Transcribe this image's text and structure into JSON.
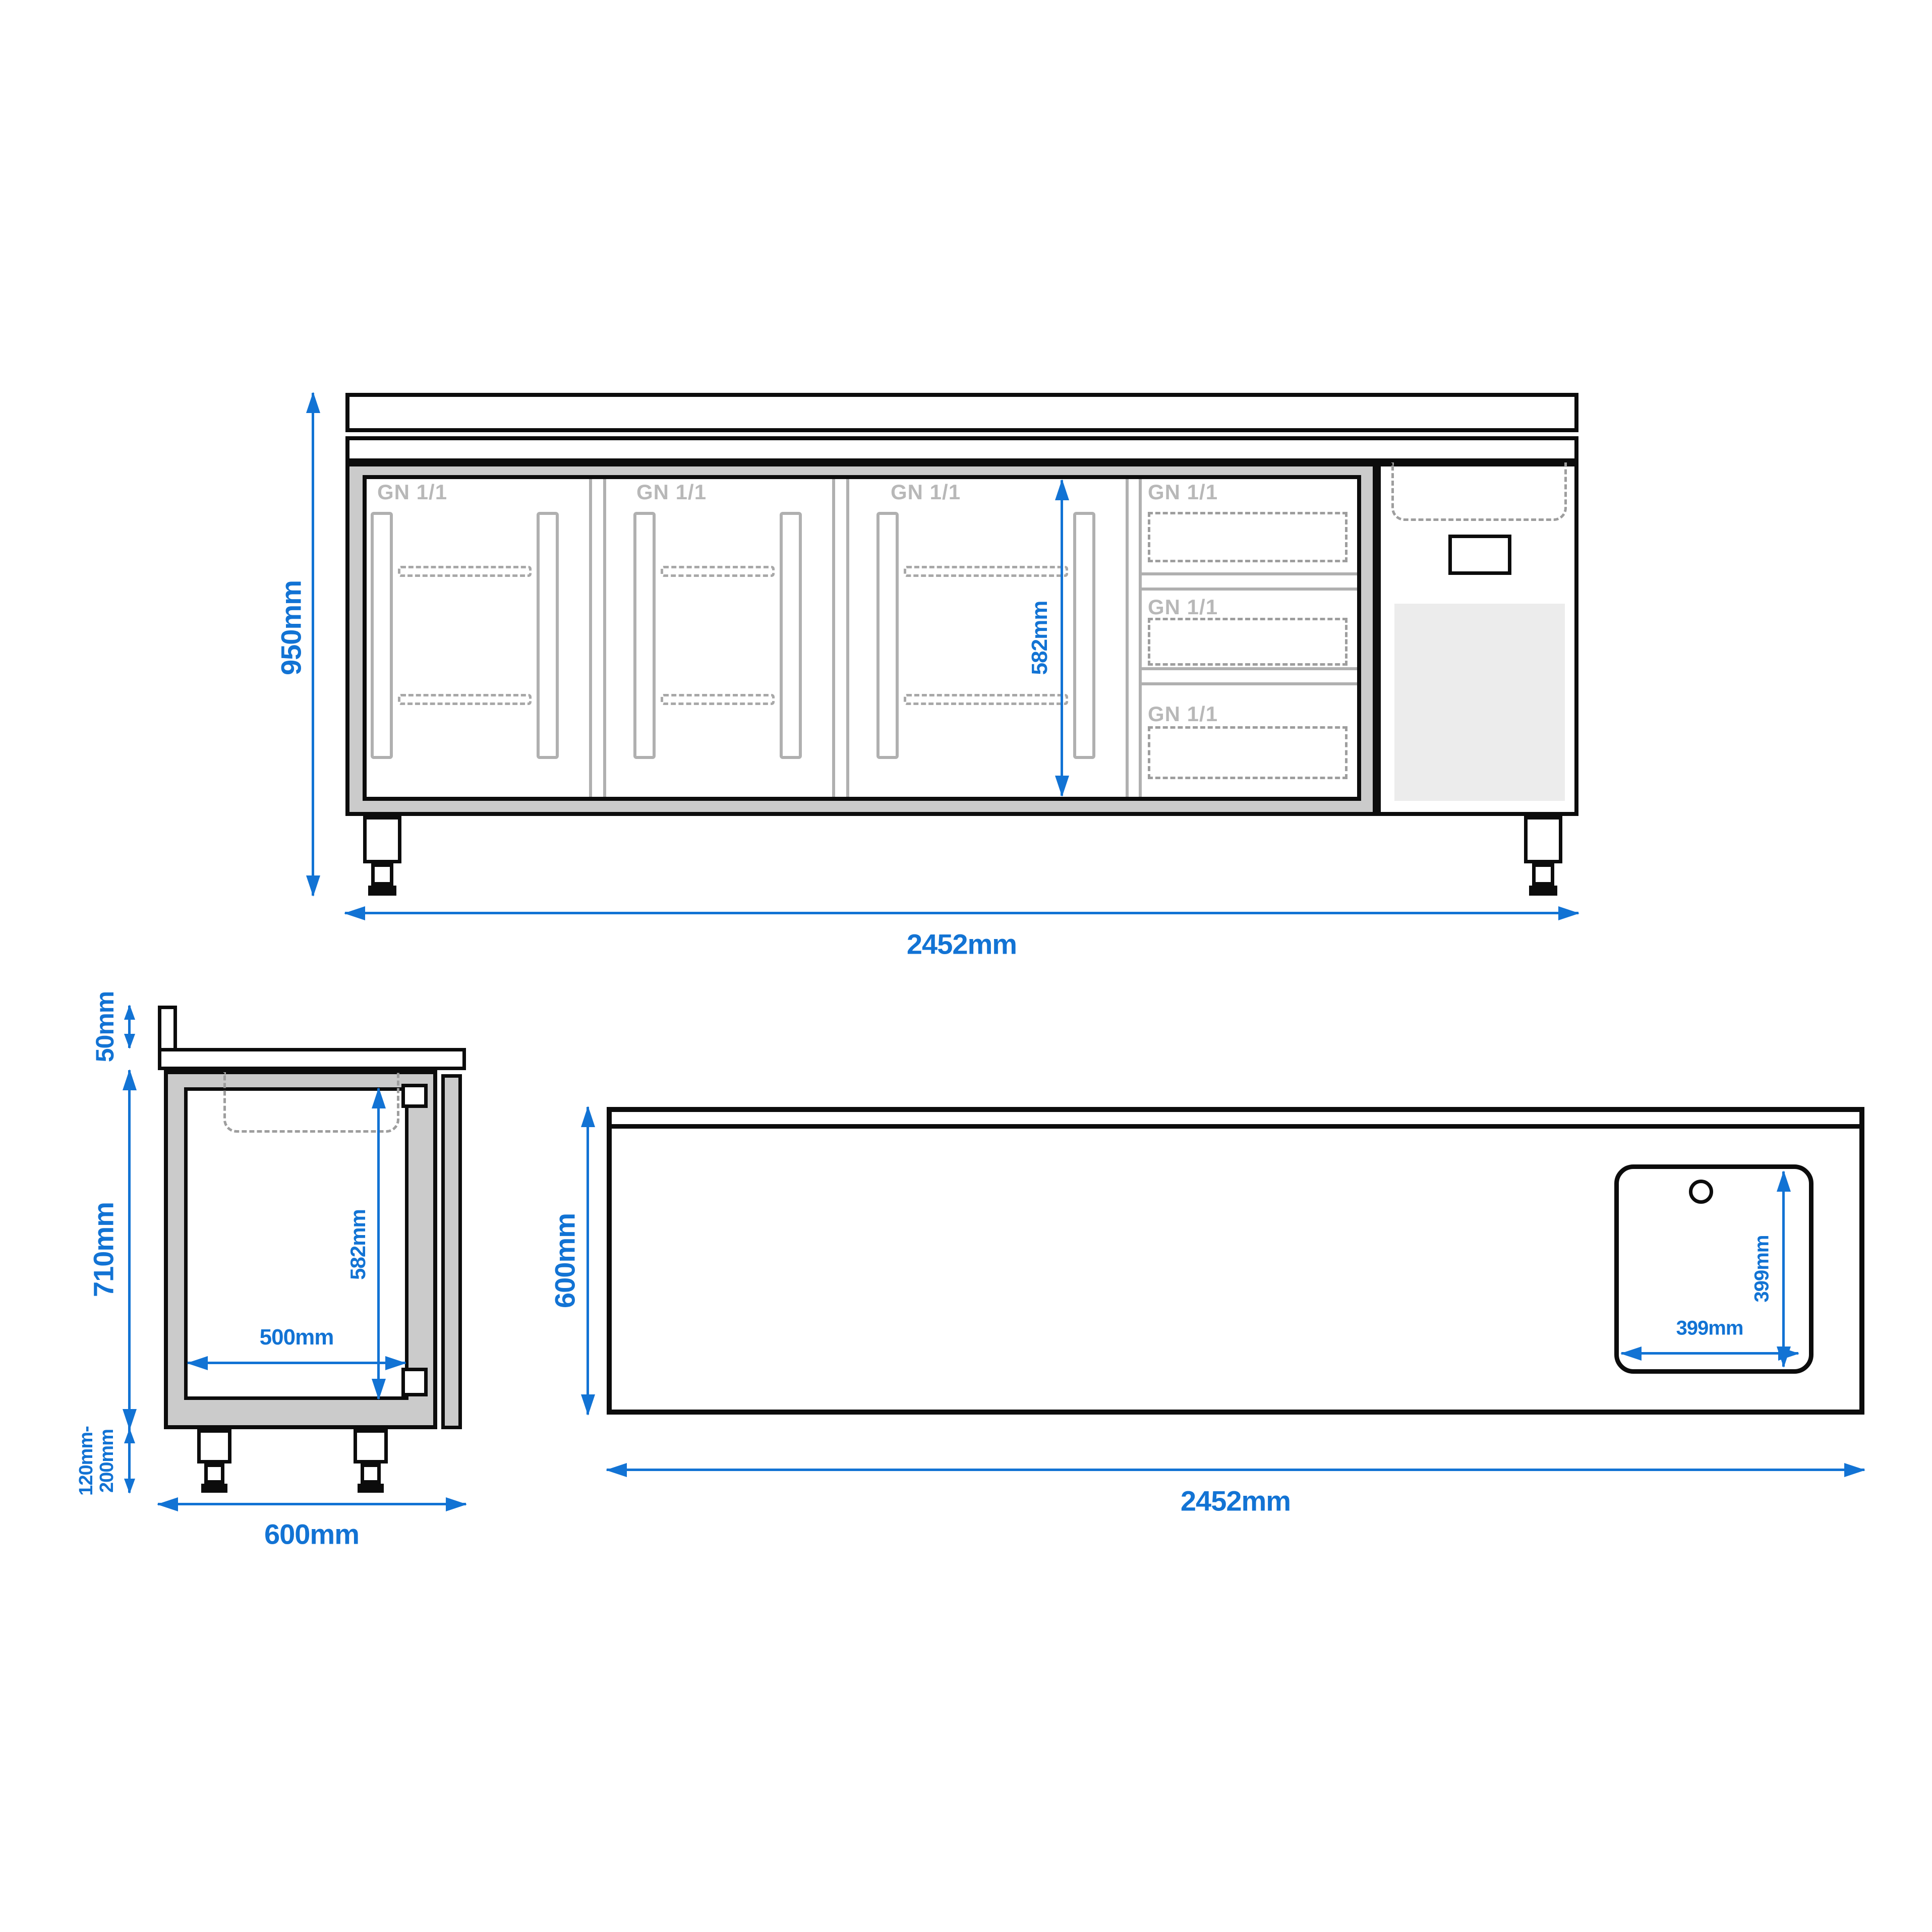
{
  "colors": {
    "dimension_blue": "#1273d4",
    "outline_black": "#0c0c0c",
    "wall_gray": "#cbcbcb",
    "detail_line_gray": "#b0b0b0",
    "gn_text_gray": "#b8b8b8",
    "dashed_gray": "#9e9e9e",
    "grille_gray": "#ececec"
  },
  "front_view": {
    "height": "950mm",
    "width": "2452mm",
    "inner_height": "582mm",
    "door_labels": [
      "GN 1/1",
      "GN 1/1",
      "GN 1/1"
    ],
    "drawer_labels": [
      "GN 1/1",
      "GN 1/1",
      "GN 1/1"
    ]
  },
  "side_view": {
    "backsplash_height": "50mm",
    "body_height": "710mm",
    "inner_height": "582mm",
    "inner_depth": "500mm",
    "leg_height_line1": "120mm-",
    "leg_height_line2": "200mm",
    "depth": "600mm"
  },
  "top_view": {
    "depth": "600mm",
    "width": "2452mm",
    "sink_width": "399mm",
    "sink_depth": "399mm"
  }
}
